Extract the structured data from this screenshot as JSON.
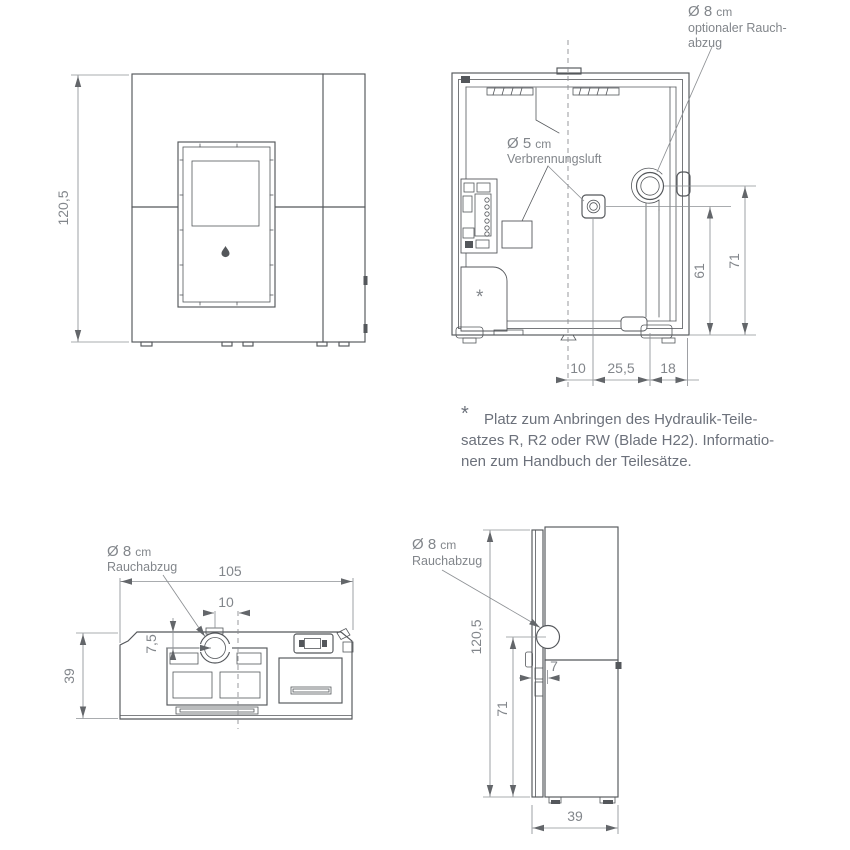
{
  "drawing": {
    "front": {
      "dim_height": "120,5"
    },
    "rear": {
      "outlet_dia": "Ø 8",
      "outlet_unit": "cm",
      "outlet_label_line2": "optionaler Rauch-",
      "outlet_label_line3": "abzug",
      "air_dia": "Ø 5",
      "air_unit": "cm",
      "air_label_line2": "Verbrennungsluft",
      "dim_air_height": "61",
      "dim_outlet_height": "71",
      "dim_center_offset": "10",
      "dim_air_to_outlet": "25,5",
      "dim_outlet_to_edge": "18",
      "hydraulic_marker": "*"
    },
    "top": {
      "outlet_dia": "Ø 8",
      "outlet_unit": "cm",
      "outlet_label_line2": "Rauchabzug",
      "dim_width": "105",
      "dim_offset": "10",
      "dim_outlet_depth": "7,5",
      "dim_depth": "39"
    },
    "side": {
      "outlet_dia": "Ø 8",
      "outlet_unit": "cm",
      "outlet_label_line2": "Rauchabzug",
      "dim_height": "120,5",
      "dim_outlet_height": "71",
      "dim_channel": "7",
      "dim_depth": "39"
    },
    "note": {
      "marker": "*",
      "line1": "Platz zum Anbringen des Hydraulik-Teile-",
      "line2": "satzes R, R2 oder RW (Blade H22). Informatio-",
      "line3": "nen zum Handbuch der Teilesätze."
    }
  },
  "colors": {
    "line": "#54575b",
    "dimension": "#8d9094",
    "text": "#82868b",
    "note_text": "#6c717b",
    "background": "#ffffff"
  }
}
